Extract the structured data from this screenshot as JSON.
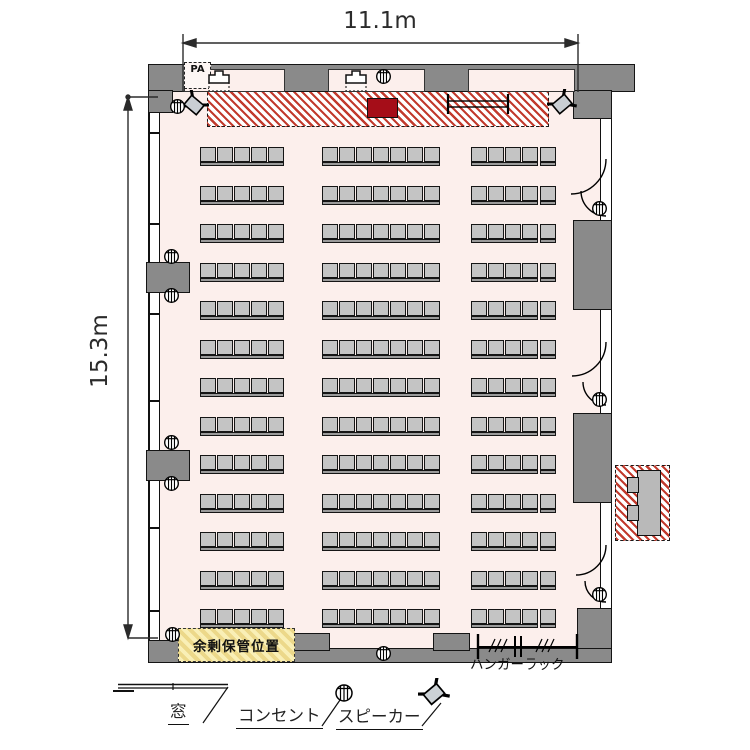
{
  "room": {
    "width_label": "11.1m",
    "height_label": "15.3m",
    "floor_type": "seminar-room-plan"
  },
  "labels": {
    "pa": "PA",
    "storage": "余剰保管位置",
    "hanger_rack": "ハンガーラック"
  },
  "legend": {
    "window": "窓",
    "outlet": "コンセント",
    "speaker": "スピーカー"
  },
  "seating": {
    "rows": 13,
    "row_groups": [
      {
        "position": "left",
        "blocks": [
          5
        ]
      },
      {
        "position": "center",
        "blocks": [
          7
        ]
      },
      {
        "position": "right",
        "blocks": [
          4,
          1
        ]
      }
    ],
    "seats_per_row": 17,
    "total_seats": 221
  },
  "fixtures": {
    "doors_right_wall": 3,
    "outlets": 11,
    "speakers": 2,
    "stage_podium": 1,
    "stage_table": 1
  },
  "colors": {
    "floor": "#fcefec",
    "wall": "#8a8a8a",
    "seat": "#c4c4c4",
    "stage_hatch": "#c23b2e",
    "podium": "#a50d18",
    "storage_bg": "#f3e49c"
  }
}
